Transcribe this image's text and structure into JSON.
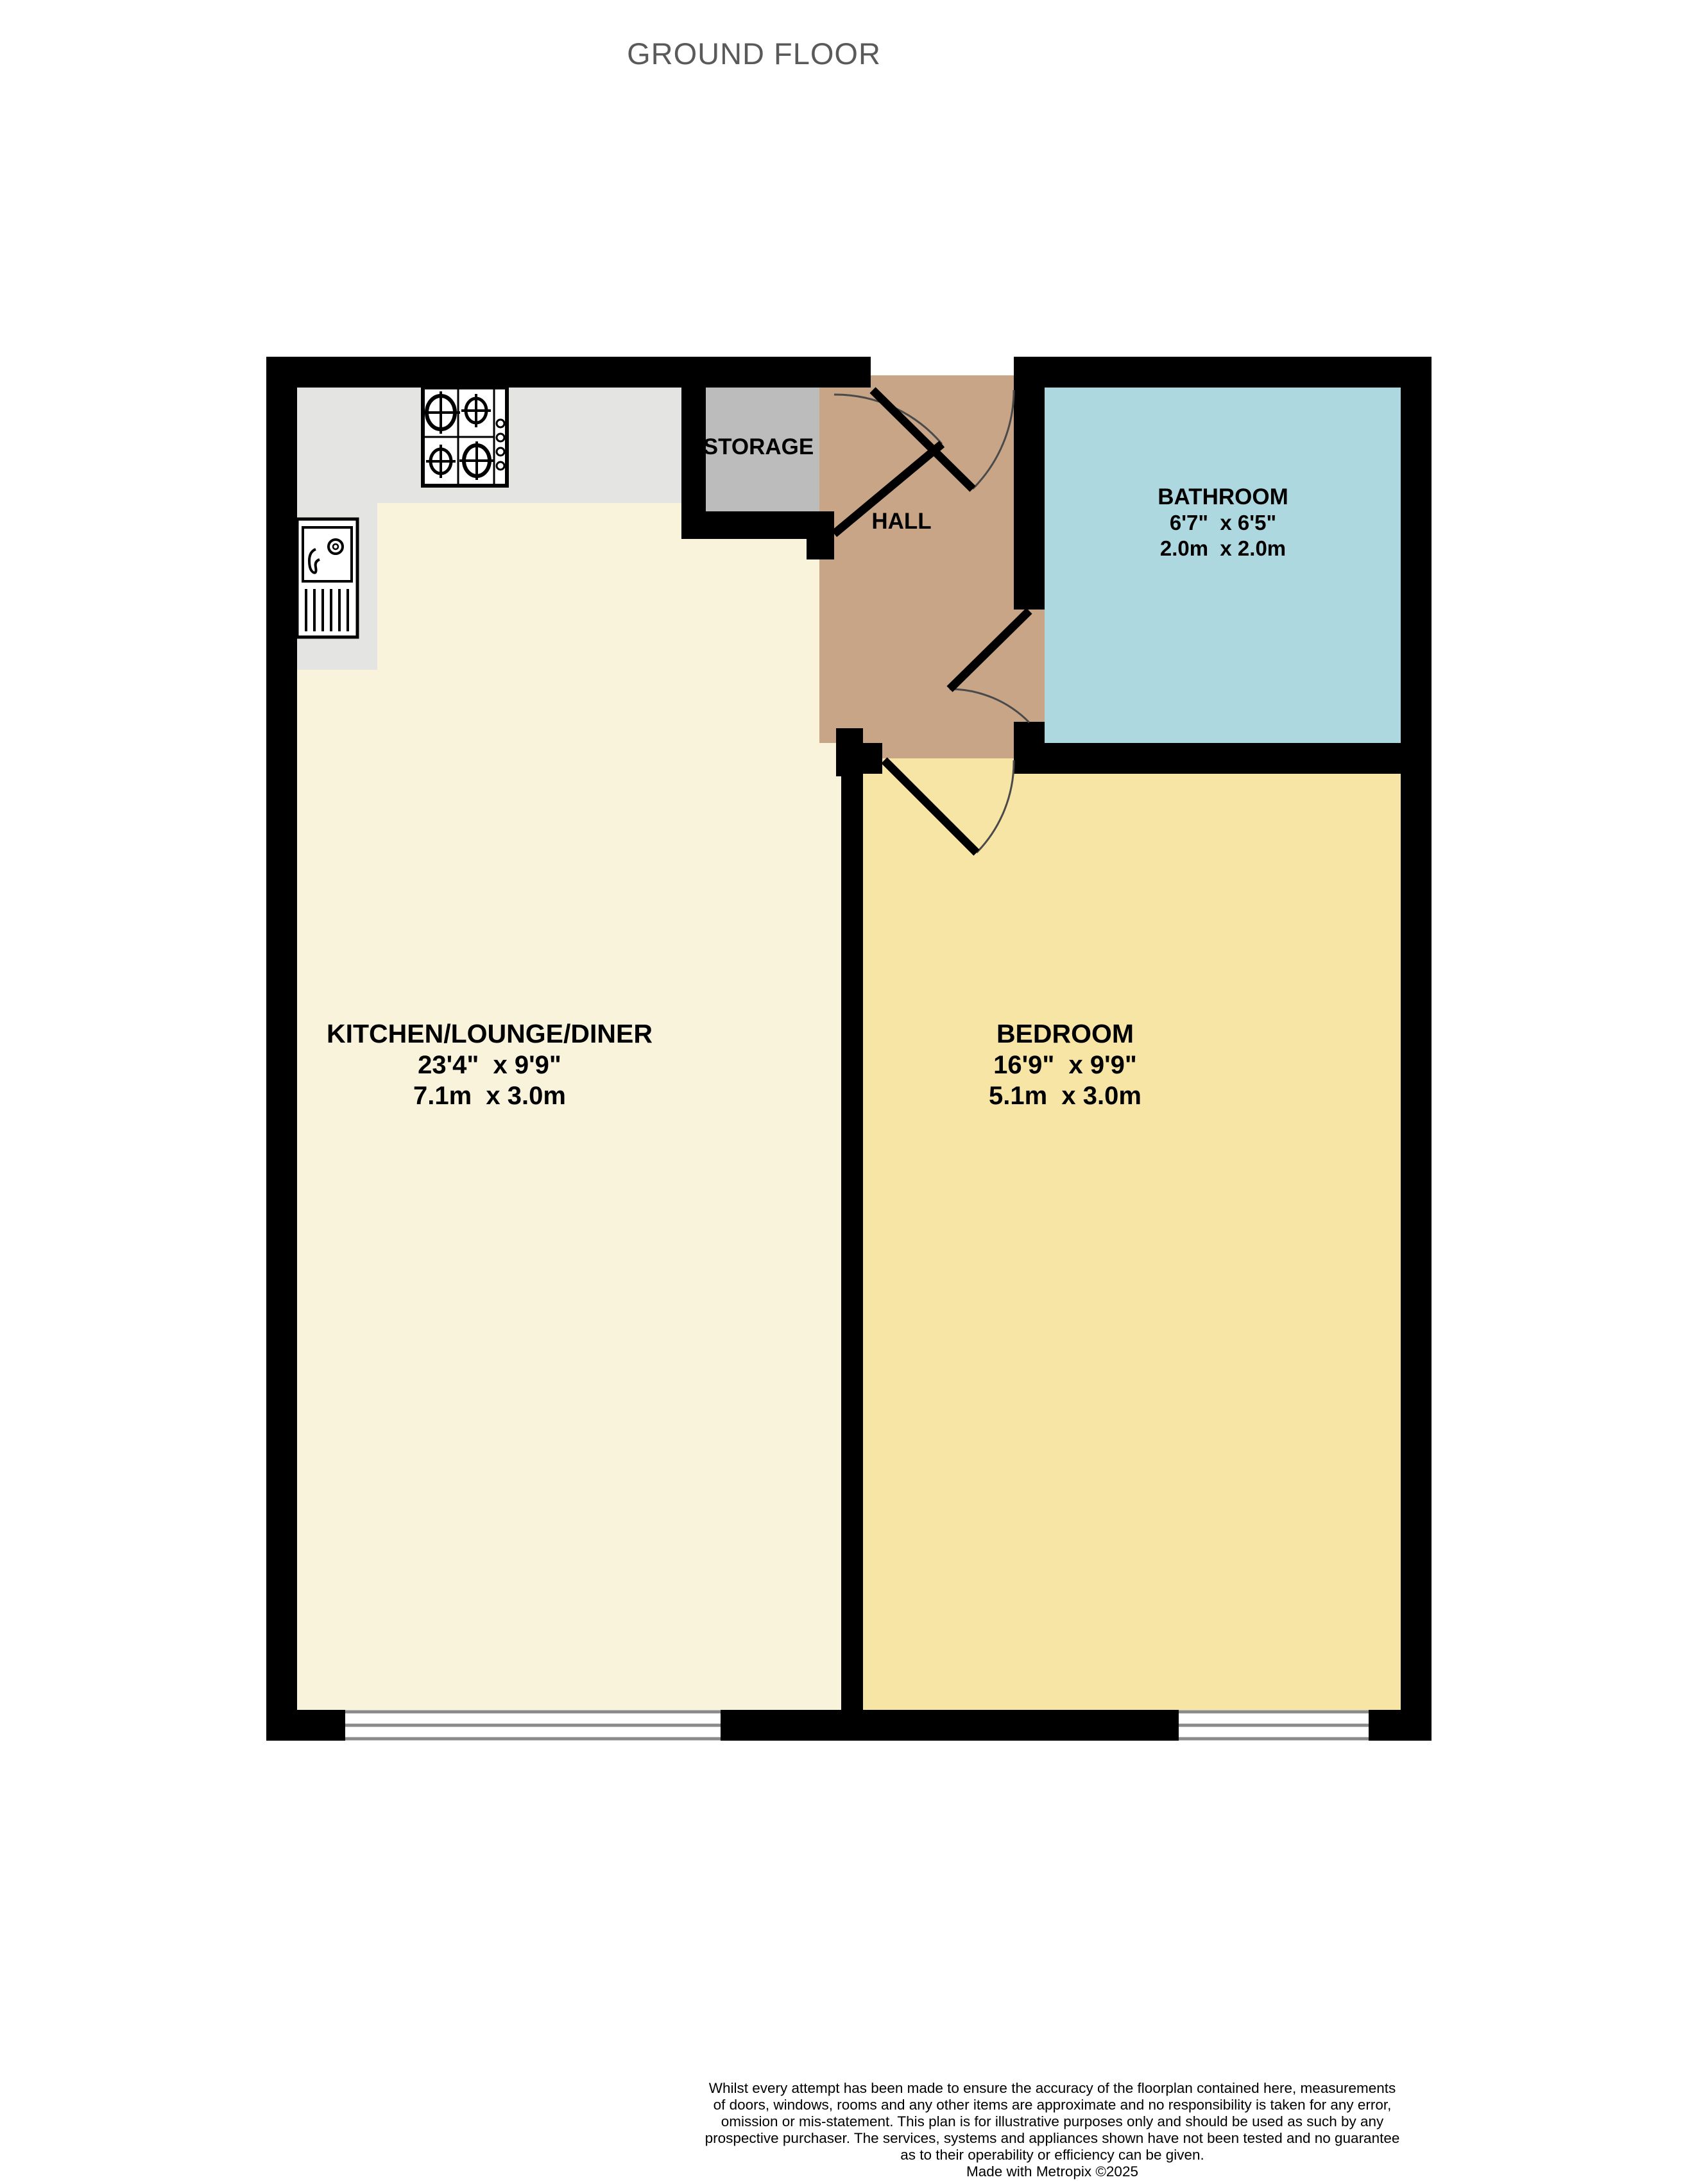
{
  "title": "GROUND FLOOR",
  "colors": {
    "wall": "#000000",
    "kitchen_floor": "#f9f3dc",
    "counter": "#e4e4e2",
    "storage_floor": "#bdbcbc",
    "hall_floor": "#c7a586",
    "bathroom_floor": "#aed8e0",
    "bedroom_floor": "#f7e5a5",
    "window_frame": "#8a8a8a",
    "door_arc": "#4a4a4a",
    "title_text": "#5a5a5a"
  },
  "rooms": {
    "kitchen": {
      "name": "KITCHEN/LOUNGE/DINER",
      "imperial": "23'4\"  x 9'9\"",
      "metric": "7.1m  x 3.0m"
    },
    "bedroom": {
      "name": "BEDROOM",
      "imperial": "16'9\"  x 9'9\"",
      "metric": "5.1m  x 3.0m"
    },
    "bathroom": {
      "name": "BATHROOM",
      "imperial": "6'7\"  x 6'5\"",
      "metric": "2.0m  x 2.0m"
    },
    "hall": {
      "name": "HALL"
    },
    "storage": {
      "name": "STORAGE"
    }
  },
  "footer": {
    "disclaimer_lines": [
      "Whilst every attempt has been made to ensure the accuracy of the floorplan contained here, measurements",
      "of doors, windows, rooms and any other items are approximate and no responsibility is taken for any error,",
      "omission or mis-statement. This plan is for illustrative purposes only and should be used as such by any",
      "prospective purchaser. The services, systems and appliances shown have not been tested and no guarantee",
      "as to their operability or efficiency can be given."
    ],
    "credit": "Made with Metropix ©2025"
  }
}
